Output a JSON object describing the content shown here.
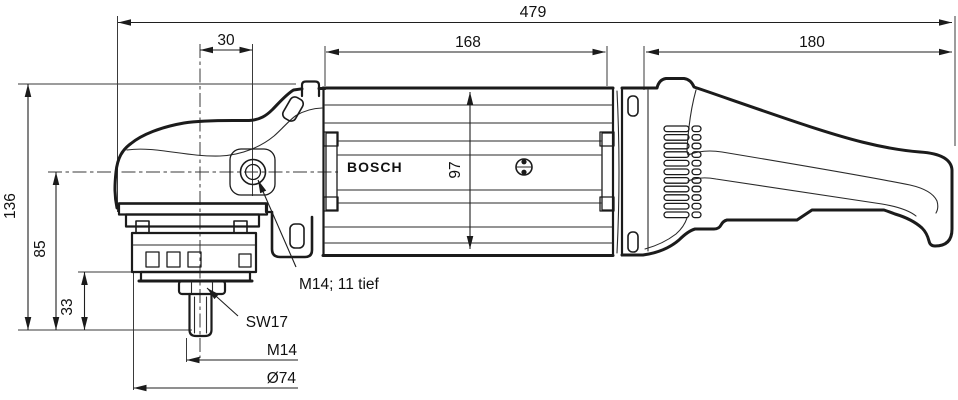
{
  "diagram": {
    "brand_label": "BOSCH",
    "dimensions": {
      "total_length": "479",
      "head_offset": "30",
      "motor_length": "168",
      "handle_length": "180",
      "total_height": "136",
      "axis_to_pad_face": "85",
      "spindle_section": "33",
      "body_height": "97"
    },
    "callouts": {
      "side_handle_thread": "M14; 11 tief",
      "wrench_size": "SW17",
      "spindle_thread": "M14",
      "flange_diameter": "Ø74"
    }
  }
}
